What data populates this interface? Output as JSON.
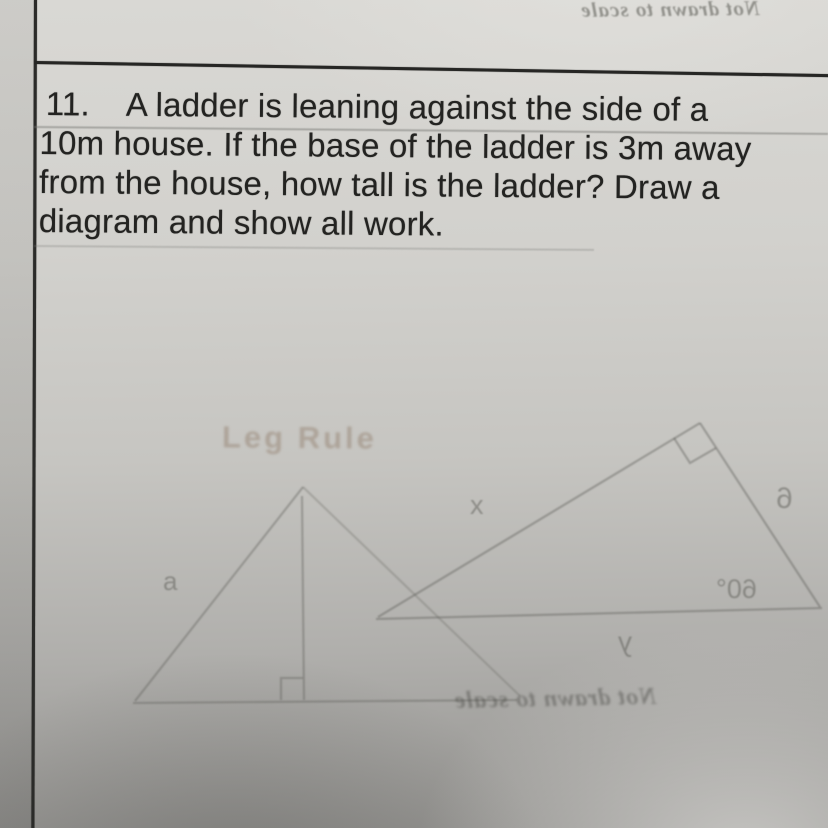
{
  "problem": {
    "number": "11.",
    "lines": [
      "A ladder is leaning against the side of a",
      "10m house. If the base of the ladder is 3m away",
      "from the house, how tall is the ladder? Draw a",
      "diagram and show all work."
    ]
  },
  "bleedthrough": {
    "top_note": "Not drawn to scale",
    "bottom_note": "Not drawn to scale",
    "left_diagram": {
      "title": "Leg Rule",
      "side_label": "a"
    },
    "right_diagram": {
      "hypotenuse_label": "x",
      "side_label": "6",
      "angle_label": "60°",
      "base_label": "y"
    }
  },
  "colors": {
    "paper_light": "#d9d8d4",
    "paper_dark": "#949390",
    "ink": "#232321",
    "border_line": "#2b2b29",
    "bleed_ink": "#8f8e8a"
  }
}
